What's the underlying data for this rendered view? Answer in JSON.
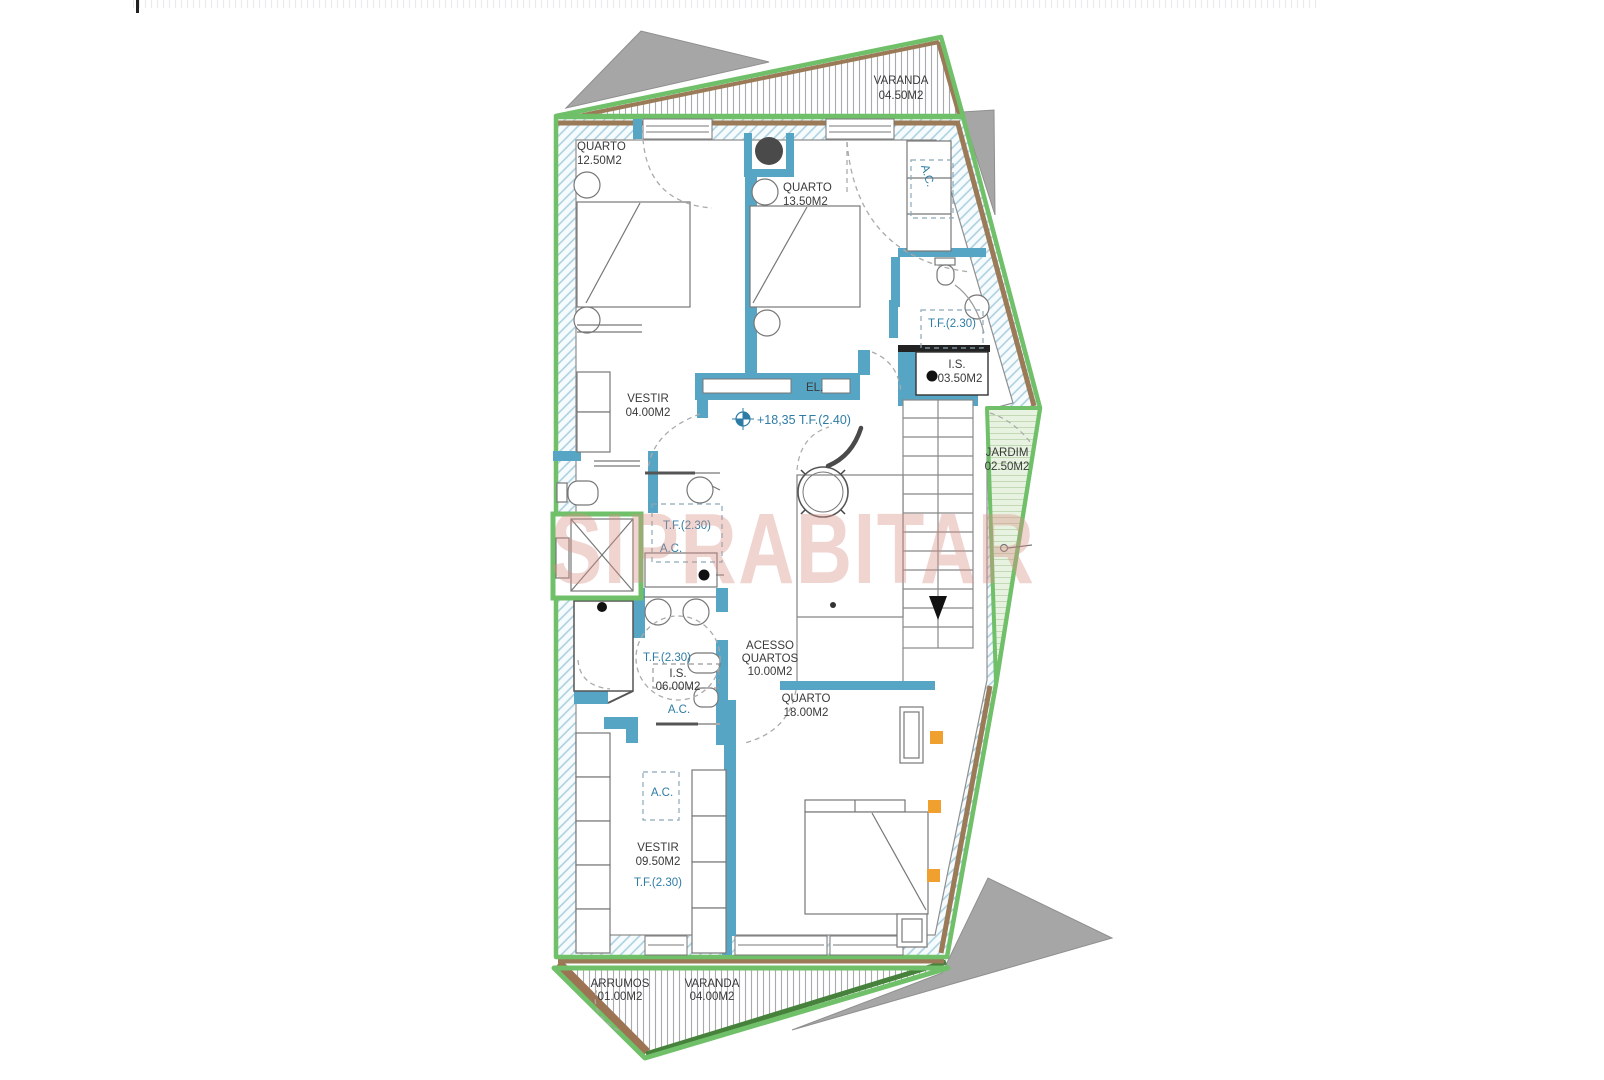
{
  "watermark": "SIPRABITAR",
  "labels": {
    "tf230": "T.F.(2.30)",
    "ac": "A.C.",
    "el": "EL.",
    "level_mark": "+18,35 T.F.(2.40)"
  },
  "rooms": {
    "varanda_top": {
      "name": "VARANDA",
      "area": "04.50M2"
    },
    "quarto_1": {
      "name": "QUARTO",
      "area": "12.50M2"
    },
    "quarto_2": {
      "name": "QUARTO",
      "area": "13.50M2"
    },
    "is_1": {
      "name": "I.S.",
      "area": "03.50M2"
    },
    "jardim": {
      "name": "JARDIM",
      "area": "02.50M2"
    },
    "vestir_1": {
      "name": "VESTIR",
      "area": "04.00M2"
    },
    "is_2": {
      "name": "I.S.",
      "area": "06.00M2"
    },
    "acesso": {
      "name_line1": "ACESSO",
      "name_line2": "QUARTOS",
      "area": "10.00M2"
    },
    "quarto_3": {
      "name": "QUARTO",
      "area": "18.00M2"
    },
    "vestir_2": {
      "name": "VESTIR",
      "area": "09.50M2"
    },
    "arrumos": {
      "name": "ARRUMOS",
      "area": "01.00M2"
    },
    "varanda_bottom": {
      "name": "VARANDA",
      "area": "04.00M2"
    }
  },
  "colors": {
    "outline_green": "#6fc069",
    "wall_hatch_blue": "#a9cede",
    "partition_teal": "#57a5c4",
    "earth_brown": "#9a7a57",
    "shadow_gray": "#a6a6a6",
    "annotation_blue": "#2e7ca6",
    "label_dark": "#3a3a3a",
    "jardim_green": "#e7f2e0",
    "accent_orange": "#f0a02e",
    "watermark_pink": "#d98f86"
  }
}
